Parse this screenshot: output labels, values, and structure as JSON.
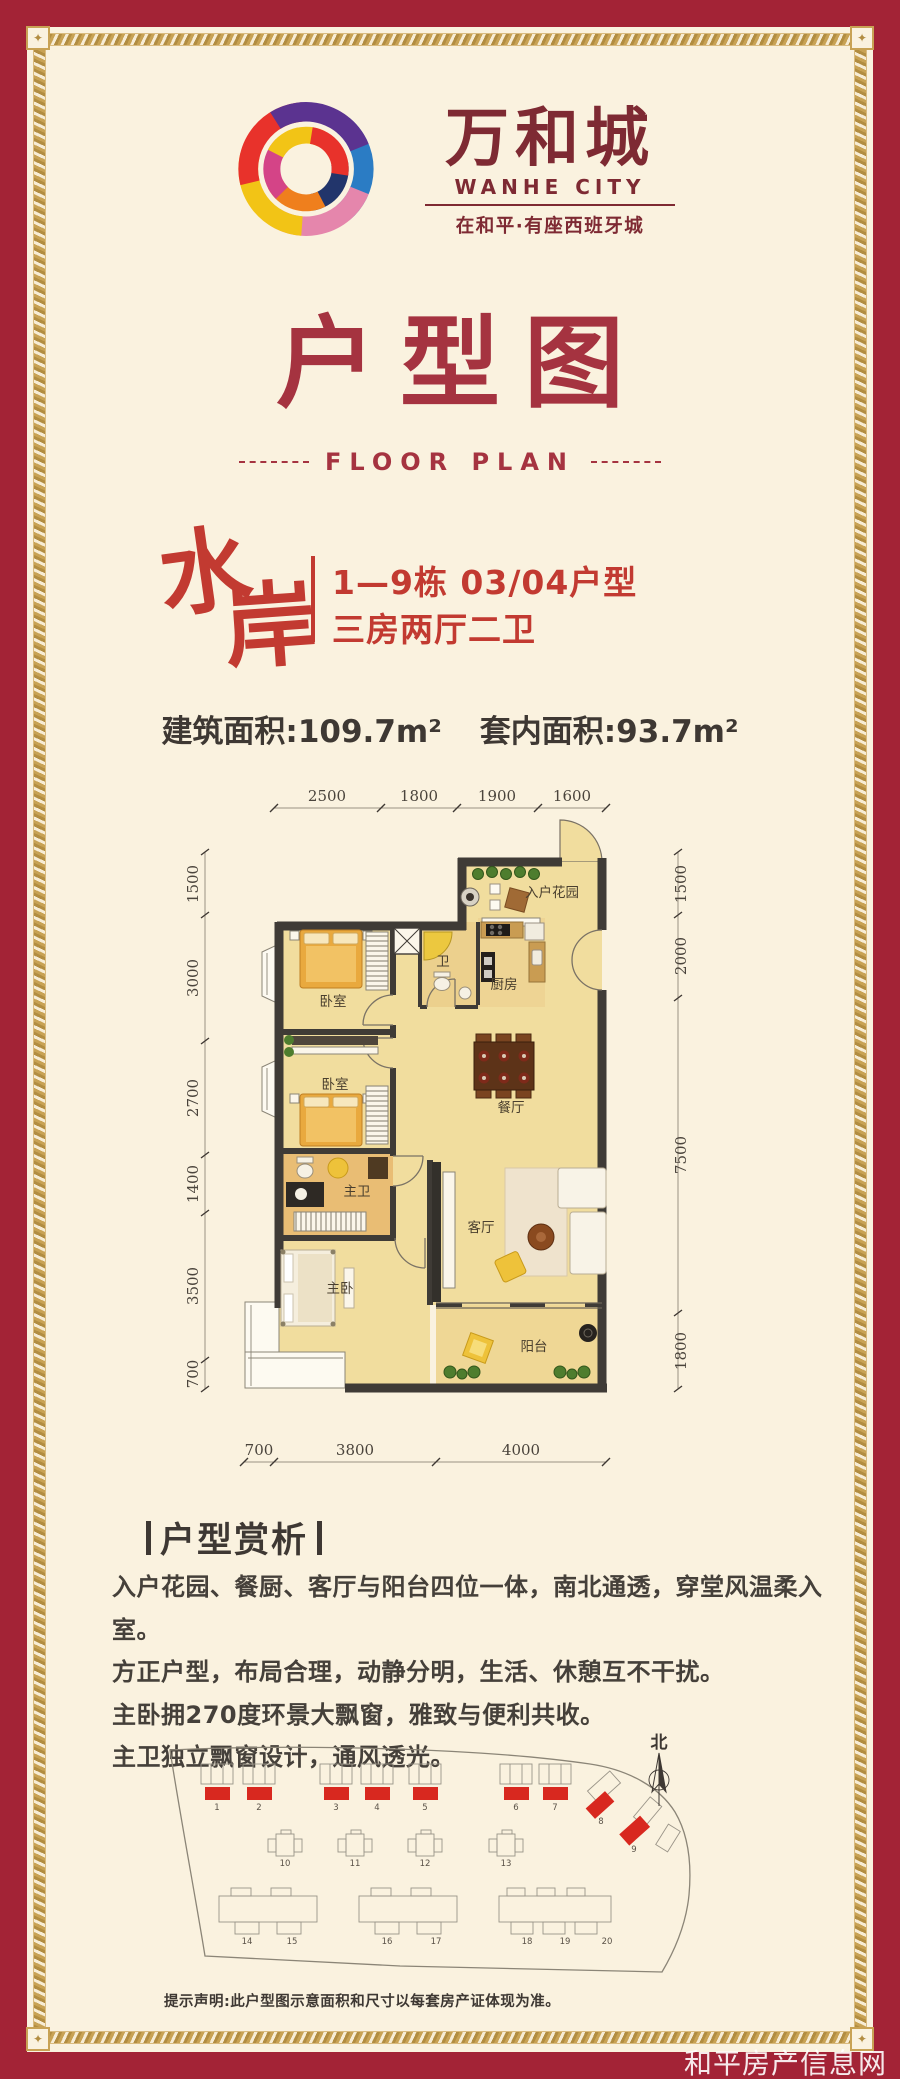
{
  "brand": {
    "name_cn": "万和城",
    "name_en": "WANHE CITY",
    "tagline": "在和平·有座西班牙城"
  },
  "title": {
    "cn": "户型图",
    "en": "FLOOR PLAN"
  },
  "unit": {
    "series_char1": "水",
    "series_char2": "岸",
    "block_line": "1—9栋 03/04户型",
    "layout_line": "三房两厅二卫",
    "area_built": "建筑面积:109.7m²",
    "area_inner": "套内面积:93.7m²"
  },
  "floorplan": {
    "dims_top": [
      "2500",
      "1800",
      "1900",
      "1600"
    ],
    "dims_bottom": [
      "700",
      "3800",
      "4000"
    ],
    "dims_left": [
      "1500",
      "3000",
      "2700",
      "1400",
      "3500",
      "700"
    ],
    "dims_right": [
      "1500",
      "2000",
      "7500",
      "1800"
    ],
    "rooms": {
      "entry_garden": "入户花园",
      "kitchen": "厨房",
      "bath": "卫",
      "bedroom1": "卧室",
      "bedroom2": "卧室",
      "dining": "餐厅",
      "master_bath": "主卫",
      "living": "客厅",
      "master_bedroom": "主卧",
      "balcony": "阳台"
    }
  },
  "analysis": {
    "heading": "户型赏析",
    "lines": [
      "入户花园、餐厨、客厅与阳台四位一体，南北通透，穿堂风温柔入室。",
      "方正户型，布局合理，动静分明，生活、休憩互不干扰。",
      "主卧拥270度环景大飘窗，雅致与便利共收。",
      "主卫独立飘窗设计，通风透光。"
    ]
  },
  "siteplan": {
    "north": "北",
    "numbers": [
      "1",
      "2",
      "3",
      "4",
      "5",
      "6",
      "7",
      "8",
      "9",
      "10",
      "11",
      "12",
      "13",
      "14",
      "15",
      "16",
      "17",
      "18",
      "19",
      "20"
    ]
  },
  "disclaimer": "提示声明:此户型图示意面积和尺寸以每套房产证体现为准。",
  "watermark": "和平房产信息网",
  "colors": {
    "frame_red": "#a32336",
    "cream": "#faf2df",
    "gold": "#c8a254",
    "brand_maroon": "#7e2a33",
    "title_red": "#a53340",
    "accent_red": "#c23a31",
    "wall": "#3f3b36",
    "floor": "#f1dd9e",
    "site_red": "#d8281f"
  }
}
